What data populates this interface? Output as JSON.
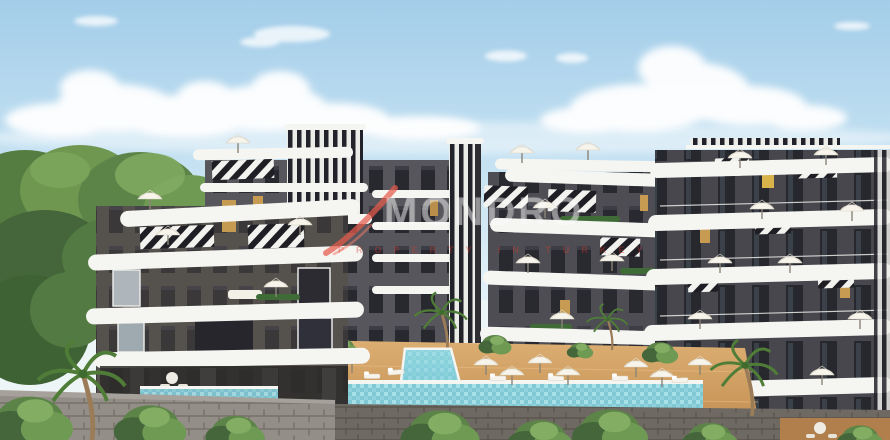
{
  "image": {
    "kind": "architectural-render-photo",
    "description": "3D render of a modern residential complex: curved white balcony apartment blocks with black-and-white striped facade accents around a courtyard with turquoise swimming pools, tan sun decks, white parasols, palm trees, green trees and a stone perimeter wall under a blue sky with clouds",
    "width_px": 890,
    "height_px": 440
  },
  "watermark": {
    "brand": "MONDRO",
    "tagline": "PROPERTY IN TURKEY",
    "brand_text_color": "rgba(250,250,250,0.42)",
    "accent_color": "#e65a4b"
  },
  "palette": {
    "sky_top": "#a3cde9",
    "sky_mid": "#c9e4f3",
    "sky_horizon": "#eaf4f9",
    "cloud_white": "#ffffff",
    "foliage_light": "#7ca75c",
    "foliage_mid": "#5d8448",
    "foliage_dark": "#44663a",
    "facade_dark_gray": "#4d4d53",
    "facade_warm_gray": "#55514c",
    "slab_white": "#f5f5f2",
    "stripe_dark": "#22222a",
    "stripe_light": "#ebebe8",
    "window_dark": "#23232a",
    "accent_yellow": "#c79b52",
    "pool_water": "#7fc8d4",
    "pool_water_light": "#a8e0e8",
    "deck_tan": "#d09c60",
    "stone_wall_light": "#938f88",
    "stone_wall_dark": "#6e6a63",
    "umbrella_cream": "#f7f4ec"
  },
  "objects": [
    "apartment buildings",
    "striped facade towers",
    "swimming pools",
    "sun umbrellas",
    "sun loungers",
    "palm trees",
    "trees and hedges",
    "stone retaining wall",
    "clouds",
    "white car"
  ]
}
